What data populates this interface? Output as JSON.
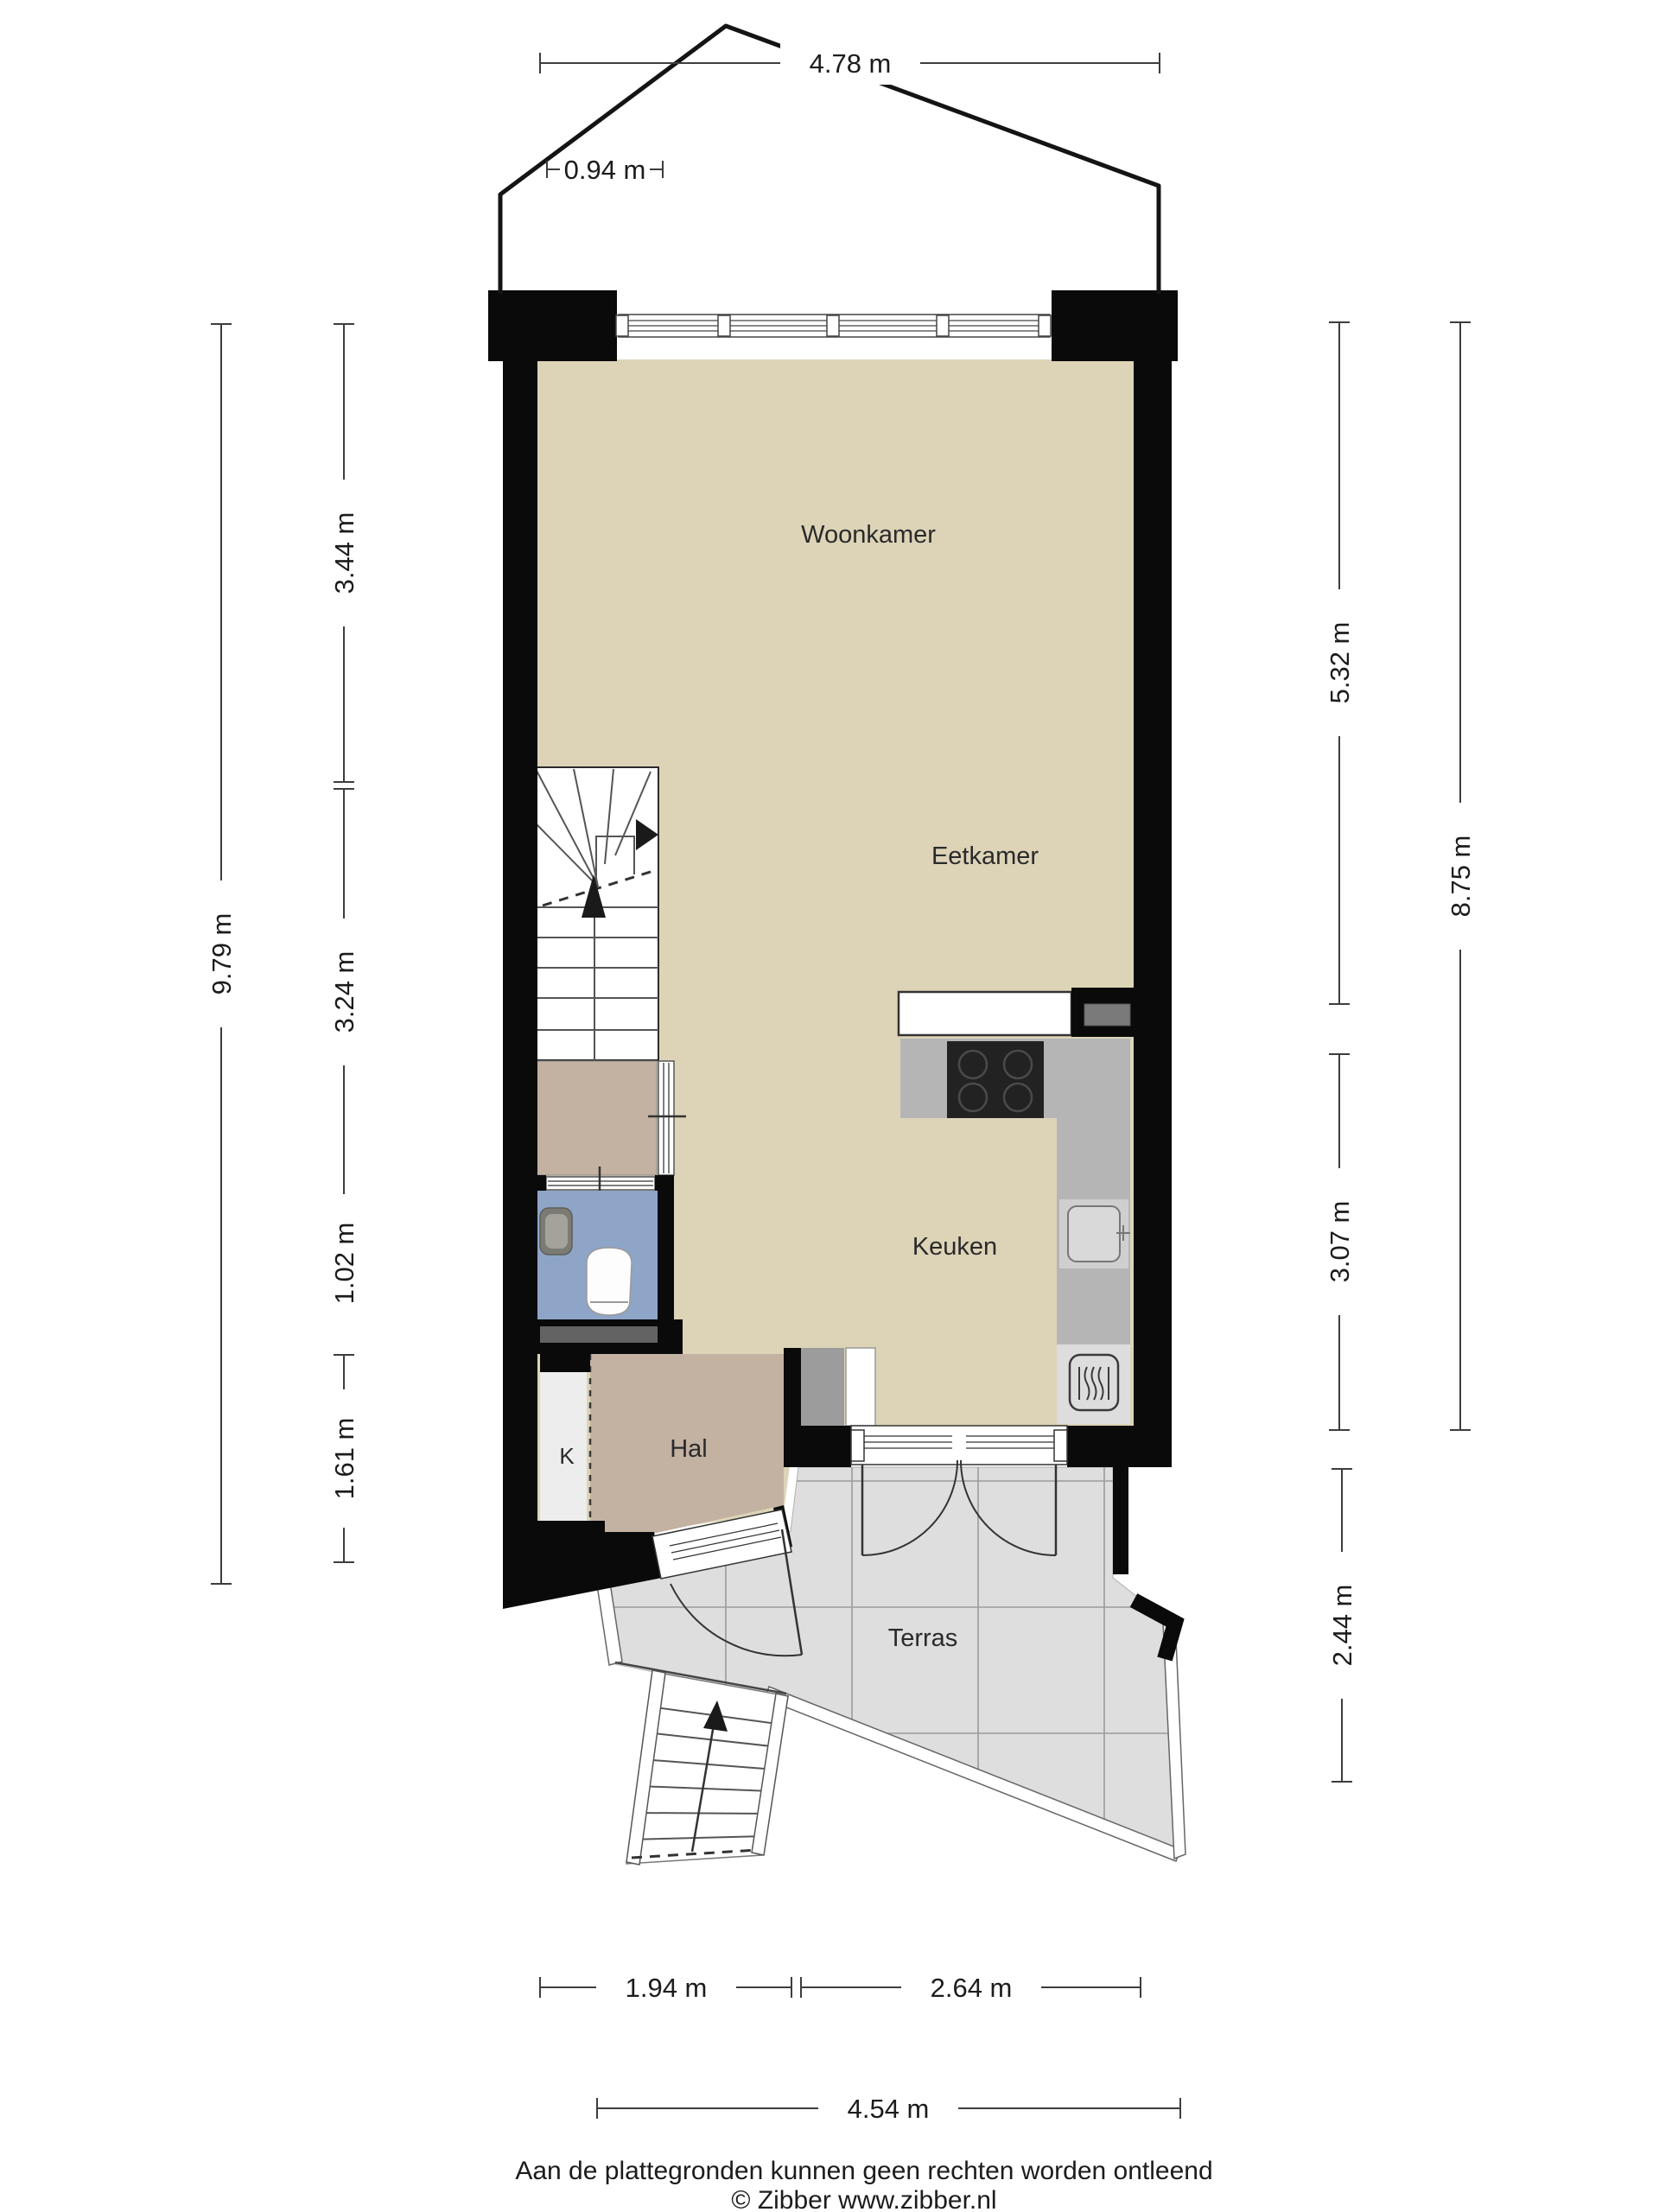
{
  "rooms": {
    "woonkamer": "Woonkamer",
    "eetkamer": "Eetkamer",
    "keuken": "Keuken",
    "hal": "Hal",
    "kast": "K",
    "terras": "Terras"
  },
  "dimensions": {
    "top_width": "4.78 m",
    "top_offset": "0.94 m",
    "left_total": "9.79 m",
    "left_seg1": "3.44 m",
    "left_seg2": "3.24 m",
    "left_seg3": "1.02 m",
    "left_seg4": "1.61 m",
    "right_seg1": "5.32 m",
    "right_seg2": "3.07 m",
    "right_seg3": "2.44 m",
    "right_total": "8.75 m",
    "bottom_seg1": "1.94 m",
    "bottom_seg2": "2.64 m",
    "bottom_total": "4.54 m"
  },
  "footer": {
    "disclaimer": "Aan de plattegronden kunnen geen rechten worden ontleend",
    "copyright": "© Zibber www.zibber.nl"
  },
  "colors": {
    "floor_main": "#ddd4b8",
    "floor_hal": "#c3b2a2",
    "floor_toilet": "#8ea5c8",
    "floor_terras": "#dedede",
    "counter_gray": "#b5b5b5",
    "duct_gray": "#9c9c9c",
    "wall_black": "#0a0a0a"
  }
}
